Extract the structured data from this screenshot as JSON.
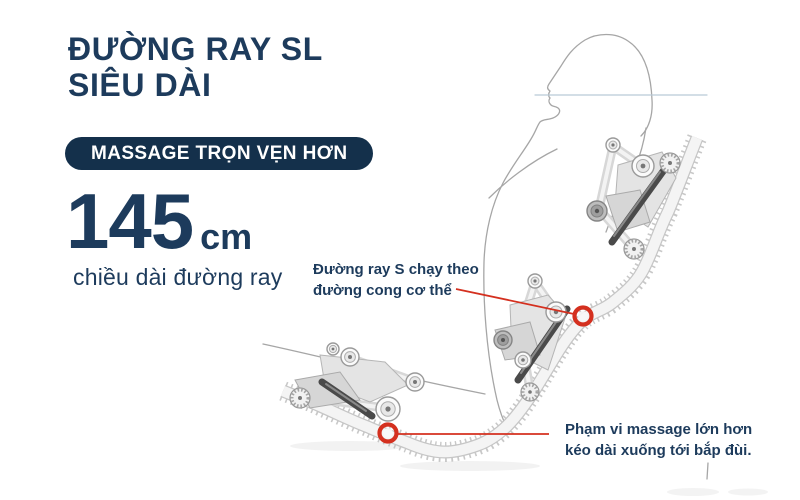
{
  "colors": {
    "navy": "#1d3b5c",
    "badge_background": "#14304b",
    "accent_red": "#d4301f",
    "silhouette_gray": "#a6a6a6"
  },
  "title": {
    "line1_regular": "ĐƯỜNG RAY",
    "line1_bold": "SL",
    "line2": "SIÊU DÀI"
  },
  "badge": {
    "label": "MASSAGE TRỌN VẸN HƠN"
  },
  "stat": {
    "value": "145",
    "unit": "cm",
    "caption": "chiều dài đường ray"
  },
  "callouts": [
    {
      "line1": "Đường ray S chạy theo",
      "line2": "đường cong cơ thể"
    },
    {
      "line1": "Phạm vi massage lớn hơn",
      "line2": "kéo dài xuống tới bắp đùi."
    }
  ]
}
